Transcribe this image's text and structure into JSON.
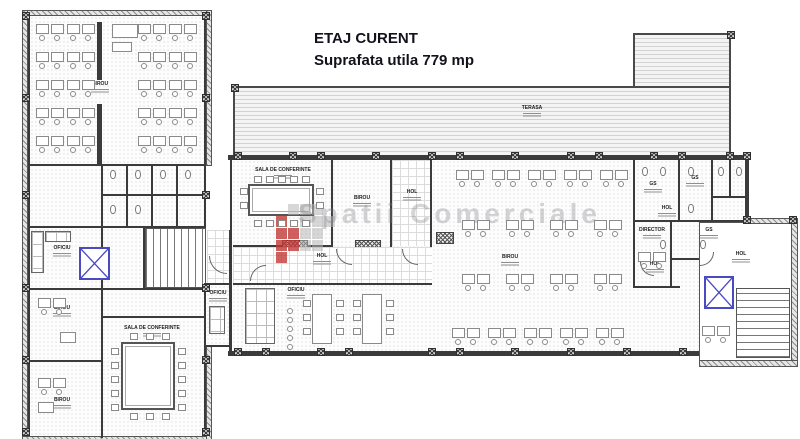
{
  "title": {
    "line1": "ETAJ CURENT",
    "line2": "Suprafata utila 779 mp"
  },
  "watermark": {
    "text": "Spatii Comerciale",
    "logo_red": "#c23835",
    "logo_gray": "#b7b7b7"
  },
  "rooms": {
    "lw_birou_top": {
      "label": "BIROU"
    },
    "lw_oficiu": {
      "label": "OFICIU"
    },
    "lw_birou_mid": {
      "label": "BIROU"
    },
    "lw_sala_conf": {
      "label": "SALA DE CONFERINTE"
    },
    "lw_birou_bot": {
      "label": "BIROU"
    },
    "oficiu_small": {
      "label": "OFICIU"
    },
    "terasa": {
      "label": "TERASA"
    },
    "c_sala_conf": {
      "label": "SALA DE CONFERINTE"
    },
    "c_birou_small": {
      "label": "BIROU"
    },
    "c_hol_top": {
      "label": "HOL"
    },
    "c_hol": {
      "label": "HOL"
    },
    "c_oficiu": {
      "label": "OFICIU"
    },
    "c_birou_open": {
      "label": "BIROU"
    },
    "r_gs1": {
      "label": "GS"
    },
    "r_gs2": {
      "label": "GS"
    },
    "r_hol_mid": {
      "label": "HOL"
    },
    "r_director": {
      "label": "DIRECTOR"
    },
    "r_gs3": {
      "label": "GS"
    },
    "r_hol_bot": {
      "label": "HOL"
    },
    "r_hol_right": {
      "label": "HOL"
    }
  }
}
